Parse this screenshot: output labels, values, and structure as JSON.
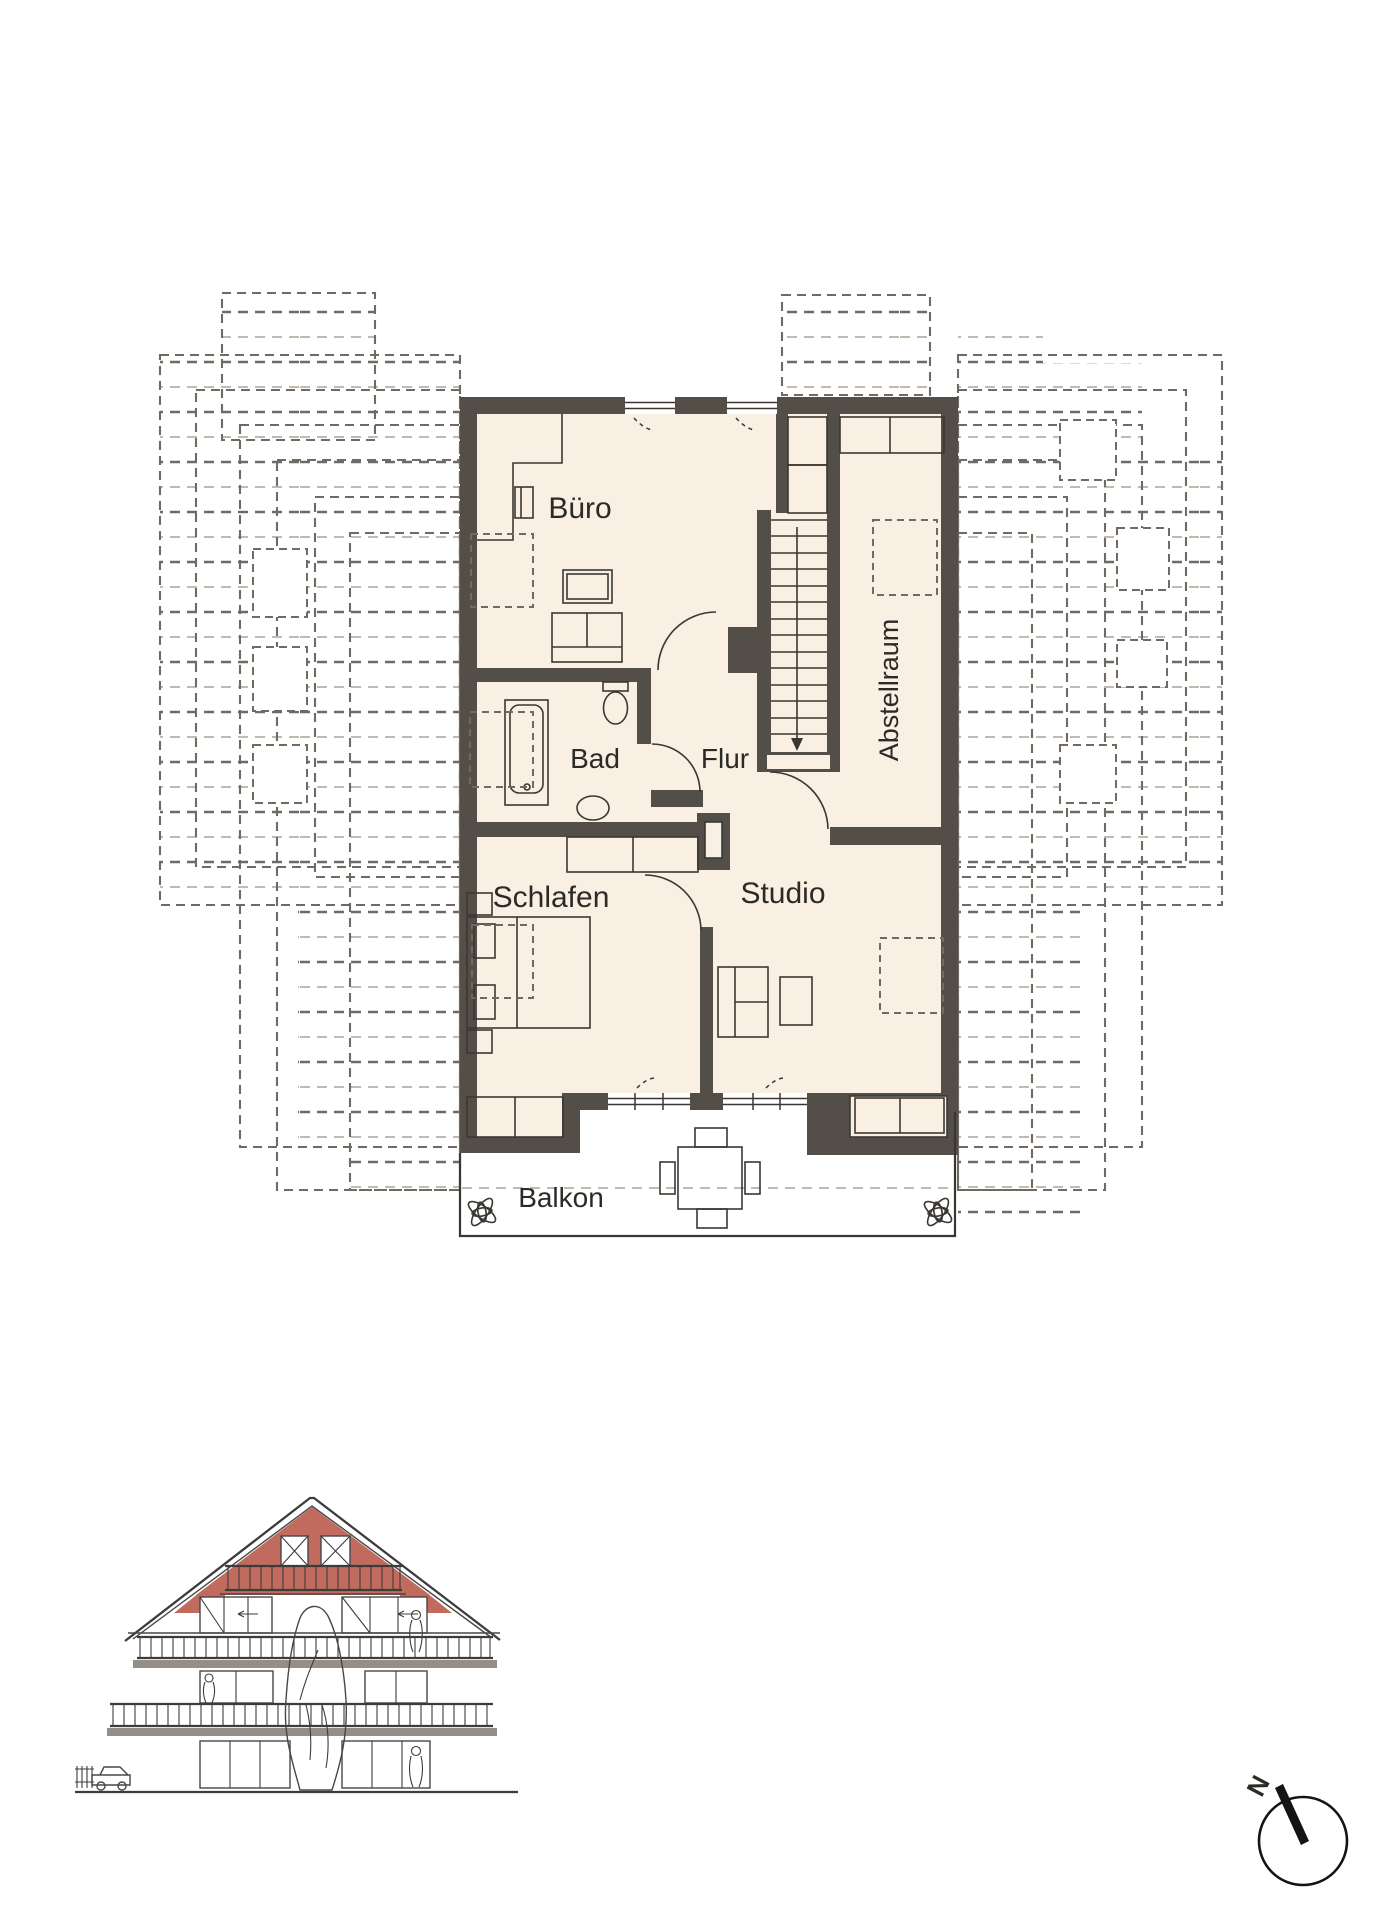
{
  "rooms": {
    "buero": "Büro",
    "bad": "Bad",
    "flur": "Flur",
    "abstellraum": "Abstellraum",
    "schlafen": "Schlafen",
    "studio": "Studio",
    "balkon": "Balkon"
  },
  "compass": {
    "north": "N"
  },
  "colors": {
    "wall": "#534e48",
    "floor": "#f9efe2",
    "outline": "#3a3733",
    "dash_dark": "#6f6a63",
    "dash_light": "#c3b9ae",
    "roof_red": "#c06b5e",
    "slab_gray": "#948e87"
  }
}
